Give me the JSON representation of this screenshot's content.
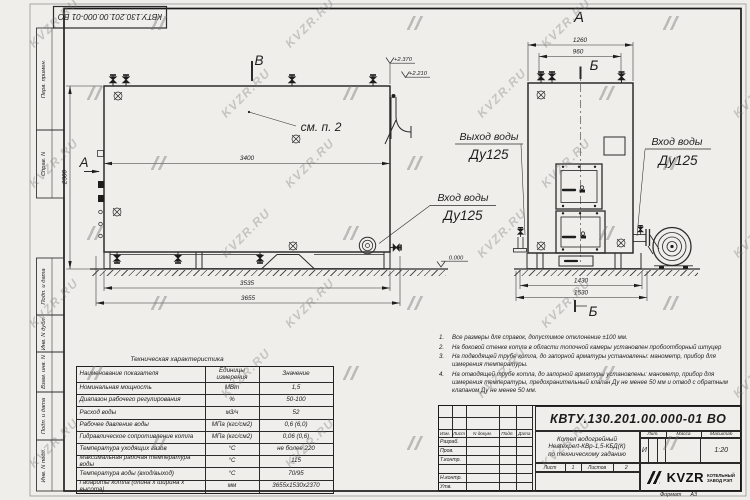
{
  "colors": {
    "line": "#2b2b2b",
    "paper": "#efeeea",
    "watermark_gray": "#737373"
  },
  "watermark": {
    "text": "KVZR.RU"
  },
  "stamp_top": {
    "doc_number": "КВТУ.130.201.00.000-01 ВО"
  },
  "margin": {
    "labels": [
      "Перв. примен.",
      "Справ. N",
      "Подп. и дата",
      "Инв. N дубл.",
      "Взам. инв. N",
      "Подп. и дата",
      "Инв. N подл."
    ]
  },
  "drawing": {
    "view_labels": {
      "a_main": "А",
      "v_main": "В",
      "a_front": "А",
      "b_front_top": "Б",
      "b_front_bottom": "Б"
    },
    "annotations": {
      "see_note": "см. п. 2",
      "outlet_title": "Выход воды",
      "outlet_dn": "Ду125",
      "inlet_main_title": "Вход воды",
      "inlet_main_dn": "Ду125",
      "inlet_front_title": "Вход воды",
      "inlet_front_dn": "Ду125"
    },
    "dims": {
      "shell_length": "3400",
      "height": "2300",
      "base_length": "3535",
      "overall_length": "3655",
      "front_width": "1260",
      "front_top_width": "960",
      "front_base_width": "1430",
      "front_overall_width": "1530"
    },
    "elevations": {
      "top": "+2.370",
      "outlet": "+2.210",
      "zero": "0.000"
    }
  },
  "notes": {
    "items": [
      {
        "num": "1.",
        "text": "Все размеры для справок, допустимое отклонение ±100 мм."
      },
      {
        "num": "2.",
        "text": "На боковой стенке котла в области топочной камеры установлен пробоотборный штуцер"
      },
      {
        "num": "3.",
        "text": "На подводящей трубе котла, до запорной арматуры установлены: манометр, прибор для измерения температуры."
      },
      {
        "num": "4.",
        "text": "На отводящей трубе котла, до запорной арматуры установлены: манометр, прибор для измерения температуры, предохранительный клапан Ду не менее 50 мм и отвод с обратным клапаном Ду не менее 50 мм."
      }
    ]
  },
  "tech_table": {
    "title": "Техническая характеристика",
    "headers": {
      "name": "Наименование показателя",
      "unit": "Единицы измерения",
      "value": "Значение"
    },
    "rows": [
      {
        "name": "Номинальная мощность",
        "unit": "МВт",
        "value": "1,5"
      },
      {
        "name": "Диапазон рабочего регулирования",
        "unit": "%",
        "value": "50-100"
      },
      {
        "name": "Расход воды",
        "unit": "м3/ч",
        "value": "52"
      },
      {
        "name": "Рабочее давление воды",
        "unit": "МПа (кгс/см2)",
        "value": "0,6 (6,0)"
      },
      {
        "name": "Гидравлическое сопротивление котла",
        "unit": "МПа (кгс/см2)",
        "value": "0,06 (0,6)"
      },
      {
        "name": "Температура уходящих газов",
        "unit": "°С",
        "value": "не более 220"
      },
      {
        "name": "Максимальная рабочая температура воды",
        "unit": "°С",
        "value": "115"
      },
      {
        "name": "Температура воды (вход/выход)",
        "unit": "°С",
        "value": "70/95"
      },
      {
        "name": "Габариты котла (длина х ширина х высота)",
        "unit": "мм",
        "value": "3655х1530х2370"
      }
    ]
  },
  "title_block": {
    "doc_number": "КВТУ.130.201.00.000-01 ВО",
    "product": {
      "line1": "Котел водогрейный",
      "line2": "Heatexpert-КВр-1,5-КБД(К)",
      "line3": "по техническому заданию"
    },
    "columns": {
      "izm": "Изм.",
      "list": "Лист",
      "doc": "N докум.",
      "podp": "Подп.",
      "data": "Дата"
    },
    "rows": {
      "razrab": "Разраб.",
      "prov": "Пров.",
      "tkontr": "Т.контр.",
      "nkontr": "Н.контр.",
      "utv": "Утв."
    },
    "lit": {
      "label": "Лит.",
      "value": "И"
    },
    "mass": {
      "label": "Масса"
    },
    "scale": {
      "label": "Масштаб",
      "value": "1:20"
    },
    "sheet": {
      "label": "Лист",
      "value": "1"
    },
    "sheets": {
      "label": "Листов",
      "value": "2"
    },
    "company": {
      "name": "KVZR",
      "sub1": "КОТЕЛЬНЫЙ",
      "sub2": "ЗАВОД РЭП"
    },
    "format": {
      "label": "Формат",
      "value": "А3"
    }
  }
}
